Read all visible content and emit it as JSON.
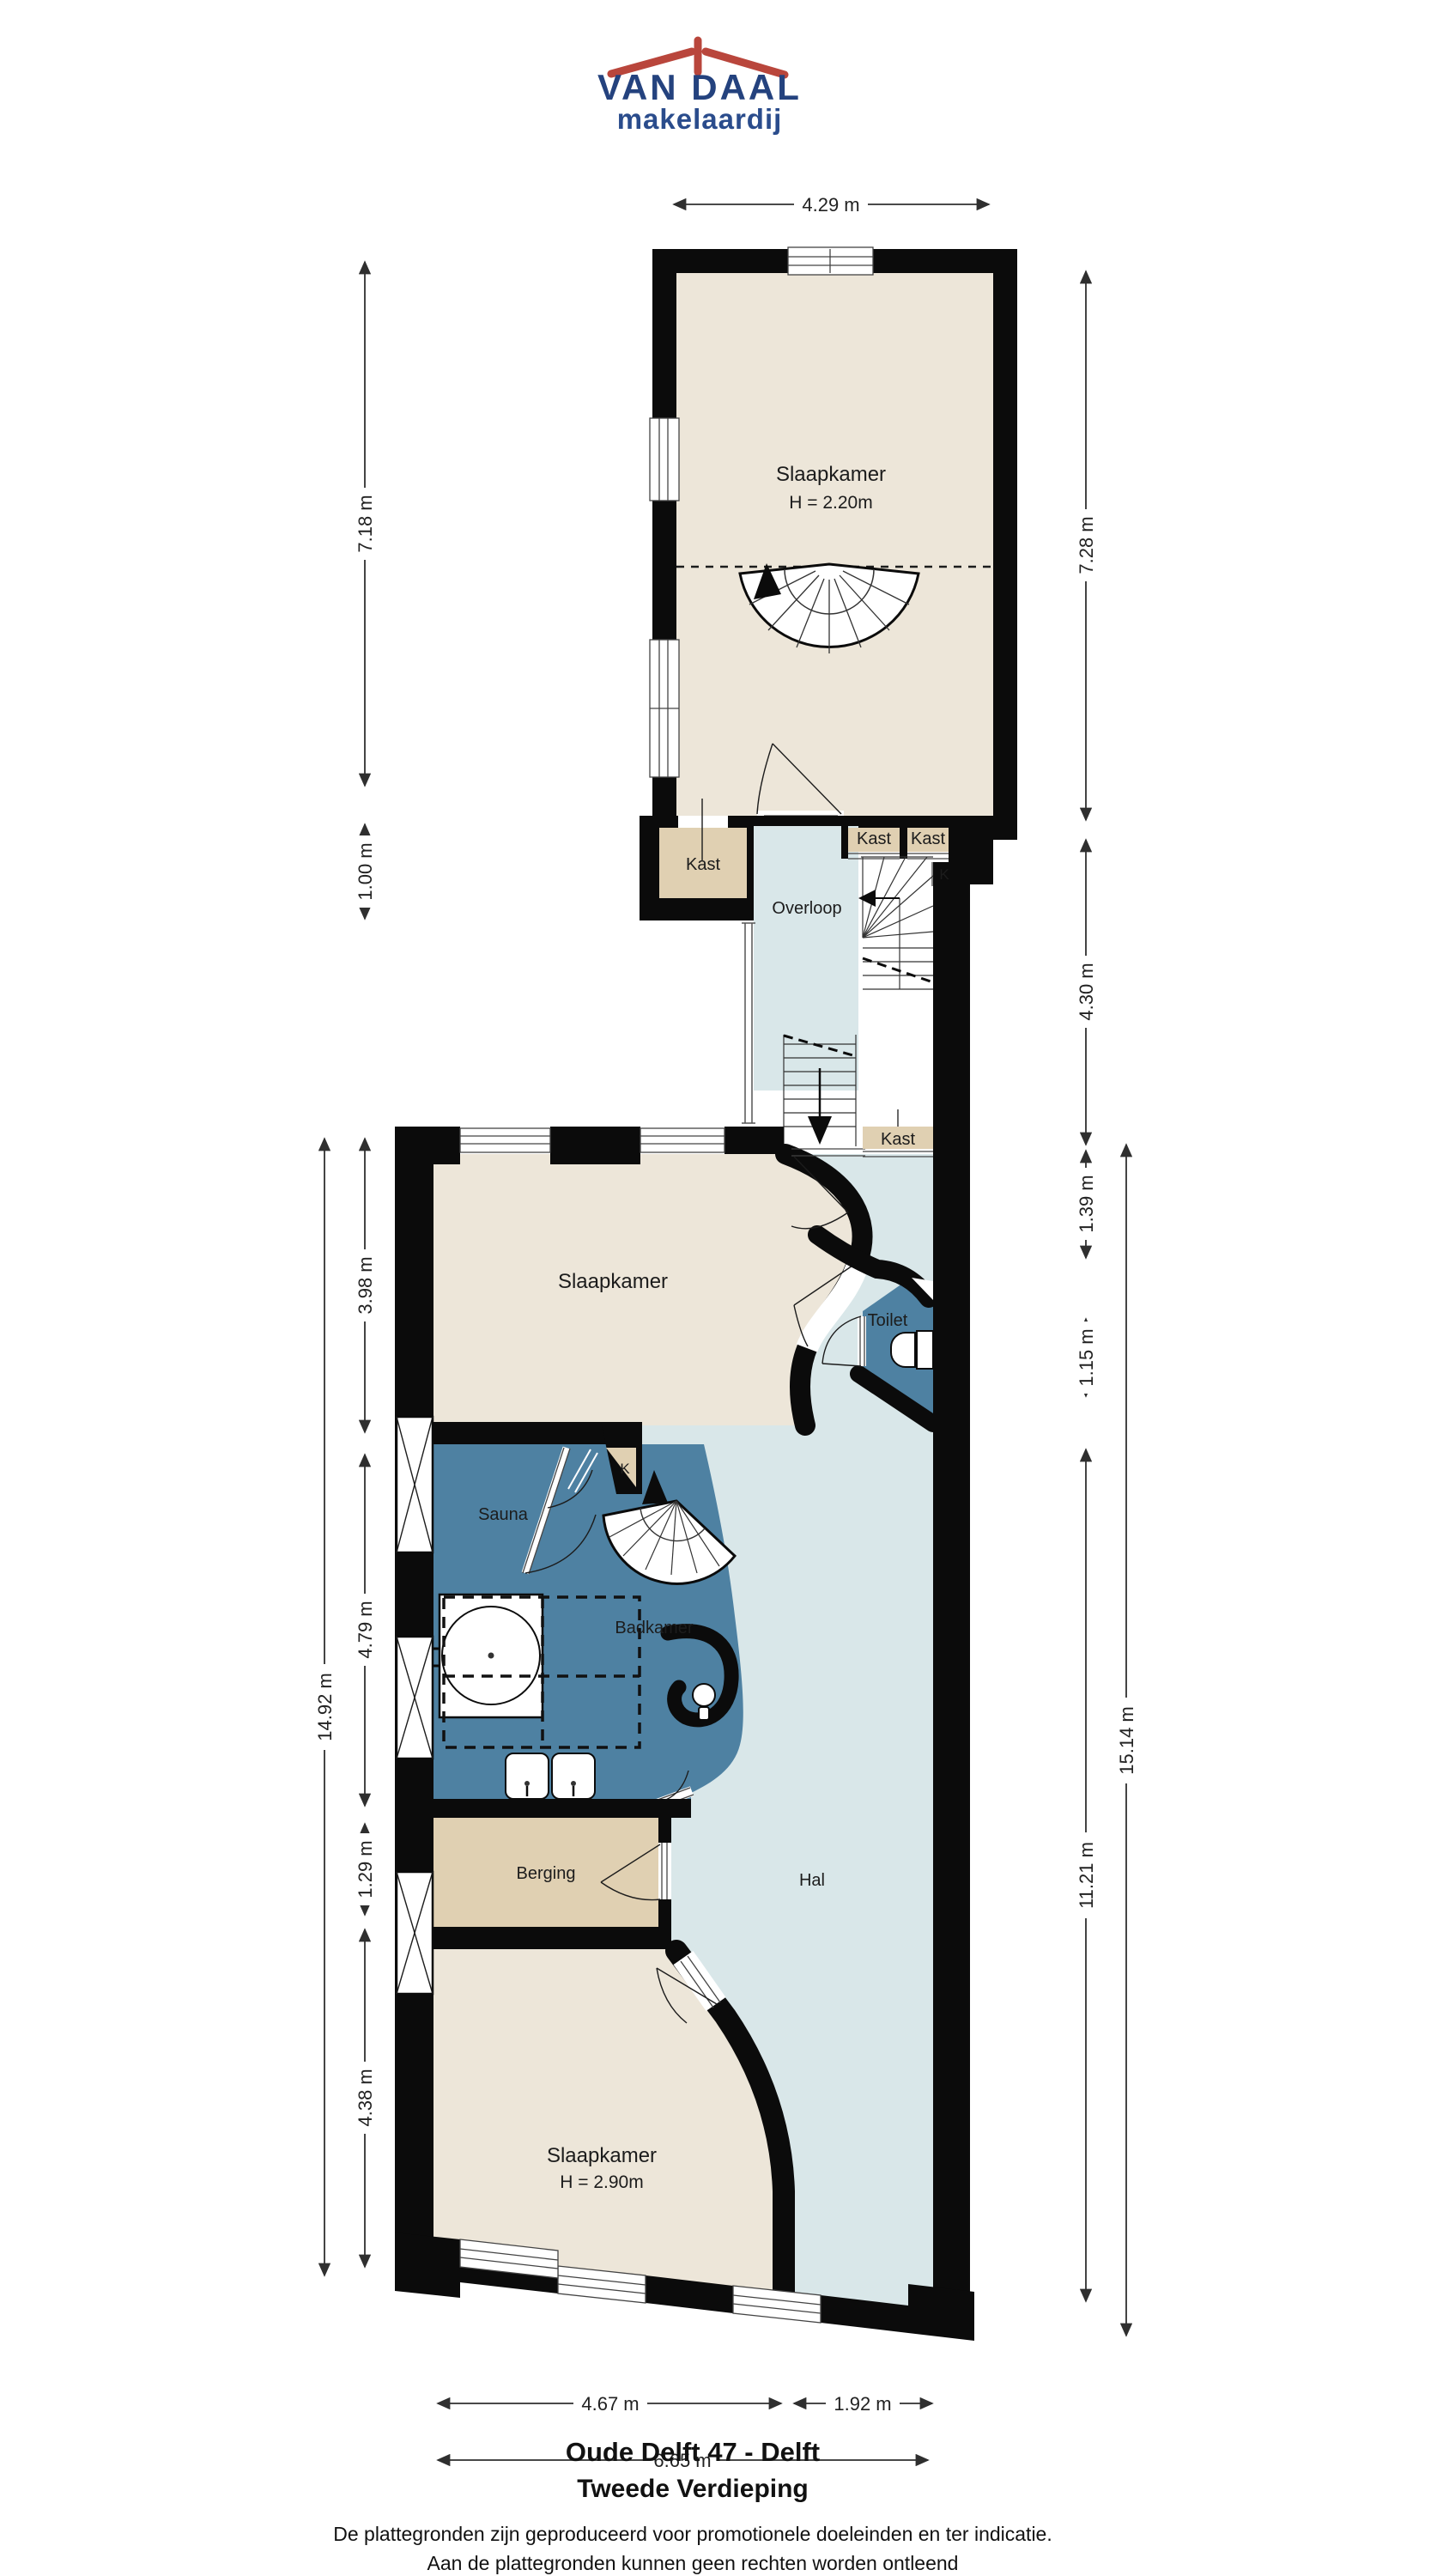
{
  "logo": {
    "name": "VAN DAAL",
    "tagline": "makelaardij"
  },
  "rooms": {
    "slaapkamer_top": {
      "label": "Slaapkamer",
      "height": "H = 2.20m"
    },
    "kast_left": "Kast",
    "overloop": "Overloop",
    "kast_mid": "Kast",
    "kast_right": "Kast",
    "k_top": "K",
    "kast_stairs": "Kast",
    "slaapkamer_mid": "Slaapkamer",
    "toilet": "Toilet",
    "k_small": "K",
    "sauna": "Sauna",
    "badkamer": "Badkamer",
    "berging": "Berging",
    "hal": "Hal",
    "slaapkamer_bottom": {
      "label": "Slaapkamer",
      "height": "H = 2.90m"
    }
  },
  "dimensions": {
    "top": "4.29 m",
    "left": [
      "7.18 m",
      "1.00 m",
      "3.98 m",
      "4.79 m",
      "1.29 m",
      "4.38 m"
    ],
    "left_total": "14.92 m",
    "right": [
      "7.28 m",
      "4.30 m",
      "1.39 m",
      "1.15 m",
      "11.21 m"
    ],
    "right_total": "15.14 m",
    "bottom": [
      "4.67 m",
      "1.92 m"
    ],
    "bottom_total": "6.65 m"
  },
  "footer": {
    "address": "Oude Delft 47 - Delft",
    "floor": "Tweede Verdieping",
    "disclaimer_line1": "De plattegronden zijn geproduceerd voor promotionele doeleinden en ter indicatie.",
    "disclaimer_line2": "Aan de plattegronden kunnen geen rechten worden ontleend"
  },
  "colors": {
    "wall": "#0b0b0b",
    "room_beige": "#ede6d9",
    "closet_tan": "#e0d0b2",
    "hall_blue": "#d9e7e9",
    "bath_blue": "#4e81a2",
    "logo_blue": "#24427e",
    "logo_red": "#b9463c"
  }
}
